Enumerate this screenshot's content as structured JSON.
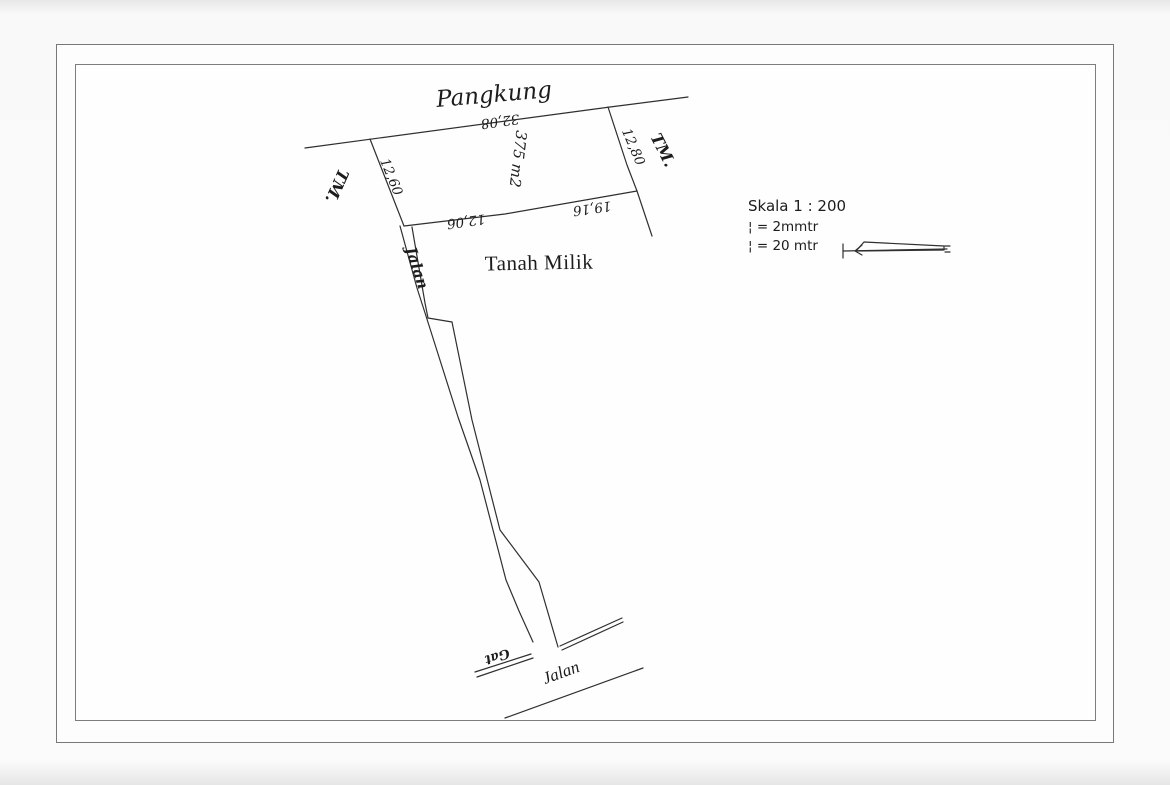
{
  "scan": {
    "pangkung_label": "Pangkung",
    "parcel": {
      "area_label": "375 m2",
      "dim_top": "32,08",
      "dim_left": "12,60",
      "dim_right": "12,80",
      "dim_bottom_left": "12,06",
      "dim_bottom_right": "19,16"
    },
    "owner_label": "Tanah Milik",
    "tm_left": "TM.",
    "tm_right": "TM.",
    "lane_label": "Jalan",
    "road_label": "Jalan",
    "gang_label": "Gat",
    "legend": {
      "scale_title": "Skala 1 : 200",
      "scale_line1": "¦ = 2mmtr",
      "scale_line2": "¦ = 20 mtr"
    },
    "colors": {
      "ink": "#2f2f2f",
      "paper": "#fefefe",
      "border_gray": "#7d7d7d"
    }
  }
}
